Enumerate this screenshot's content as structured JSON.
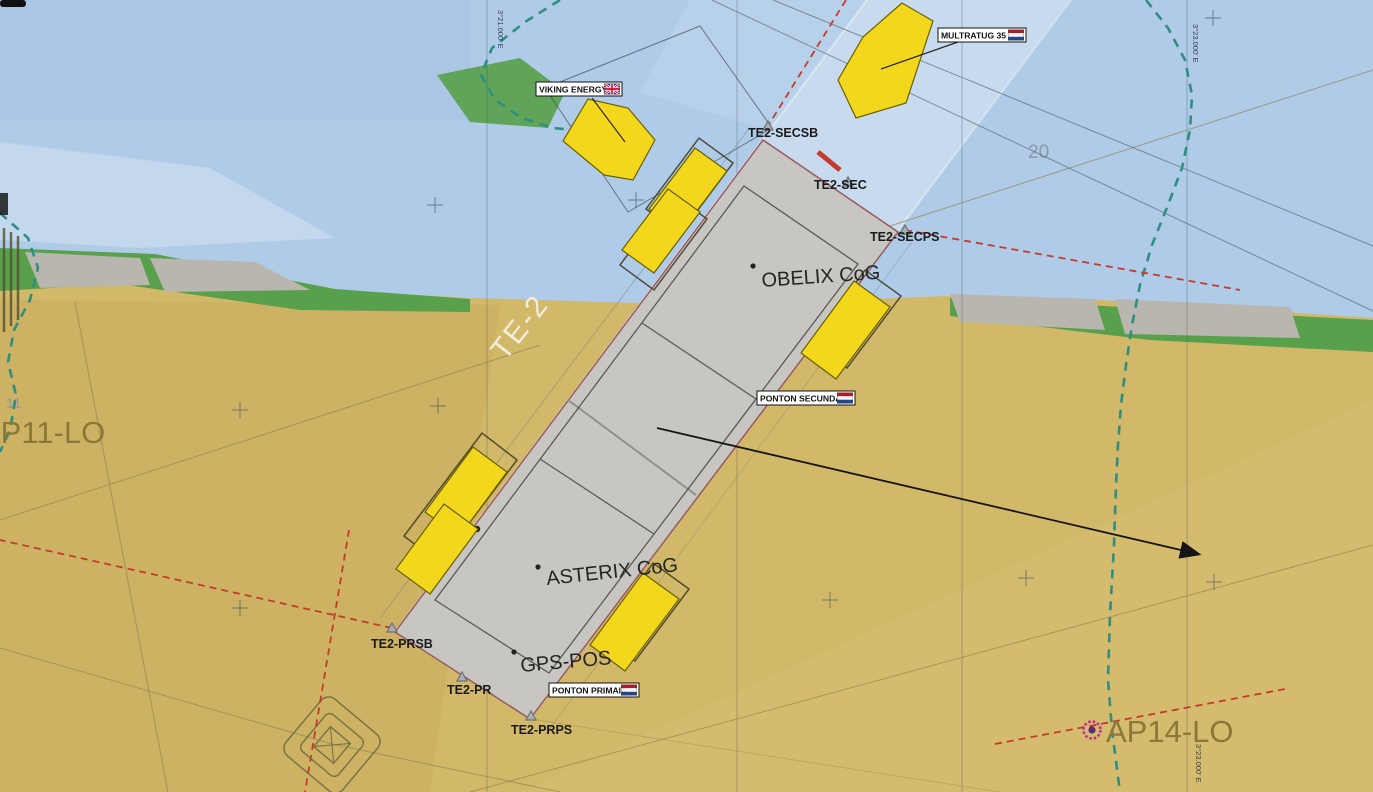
{
  "vessels": {
    "viking": {
      "name": "VIKING ENERGY",
      "flag": "gb"
    },
    "multratug": {
      "name": "MULTRATUG 35",
      "flag": "nl"
    },
    "ponton_secundair": {
      "name": "PONTON SECUNDAIR",
      "flag": "nl"
    },
    "ponton_primair": {
      "name": "PONTON PRIMAIR",
      "flag": "nl"
    }
  },
  "waypoints": {
    "secsb": "TE2-SECSB",
    "sec": "TE2-SEC",
    "secps": "TE2-SECPS",
    "prsb": "TE2-PRSB",
    "pr": "TE2-PR",
    "prps": "TE2-PRPS"
  },
  "points": {
    "obelix_cog": "OBELIX CoG",
    "asterix_cog": "ASTERIX CoG",
    "gps_pos": "GPS-POS"
  },
  "anchors": {
    "ap11": "AP11-LO",
    "ap14": "AP14-LO"
  },
  "chart": {
    "area": "TE-2",
    "sounding_20": "20",
    "sounding_11": "11",
    "meridian_left": "3°21.000' E",
    "meridian_right": "3°23.000' E"
  },
  "colors": {
    "vessel_yellow": "#f2d71c",
    "pontoon_gray": "#c7c6c2",
    "anchor_line_red": "#c43b2e",
    "boundary_teal": "#2e8f80",
    "anchor_point_magenta": "#c22a96",
    "sand": "#d2b869",
    "water": "#afcbe7",
    "shore_green": "#58a04b"
  }
}
